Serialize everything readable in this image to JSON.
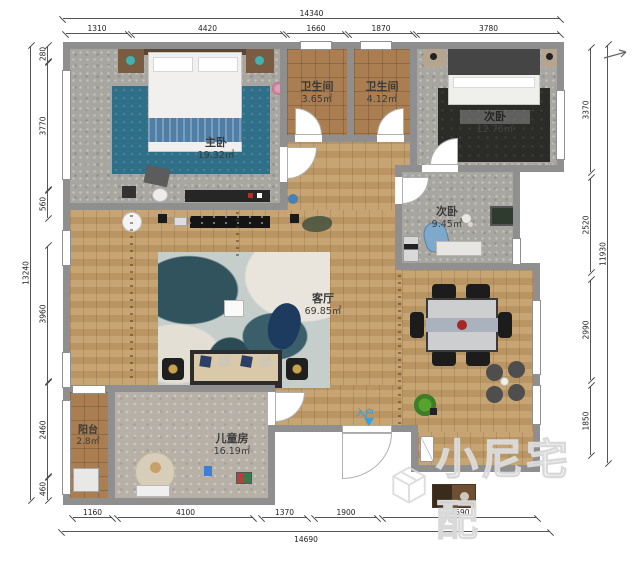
{
  "plan": {
    "rooms": [
      {
        "name": "主卧",
        "area": "19.32㎡"
      },
      {
        "name": "卫生间",
        "area": "3.65㎡"
      },
      {
        "name": "卫生间",
        "area": "4.12㎡"
      },
      {
        "name": "次卧",
        "area": "12.76㎡"
      },
      {
        "name": "次卧",
        "area": "9.45㎡"
      },
      {
        "name": "客厅",
        "area": "69.85㎡"
      },
      {
        "name": "阳台",
        "area": "2.8㎡"
      },
      {
        "name": "儿童房",
        "area": "16.19㎡"
      }
    ],
    "entry_label": "入户"
  },
  "dimensions": {
    "top": {
      "total": "14340",
      "segments": [
        "1310",
        "4420",
        "1660",
        "1870",
        "3780"
      ]
    },
    "bottom": {
      "total": "14690",
      "segments": [
        "1160",
        "4100",
        "1370",
        "1900",
        "4590"
      ]
    },
    "left": {
      "total": "13240",
      "segments": [
        "280",
        "3770",
        "560",
        "3960",
        "2460",
        "460"
      ]
    },
    "right": {
      "total": "11930",
      "segments": [
        "3370",
        "2520",
        "2990",
        "1850"
      ]
    }
  },
  "watermark": {
    "text": "小尼宅配"
  },
  "colors": {
    "wall": "#8f8f8f",
    "wood": "#c39d68",
    "carpet": "#a8a6a0",
    "tile": "#ab7e51",
    "rug_blue": "#2f6f88"
  }
}
